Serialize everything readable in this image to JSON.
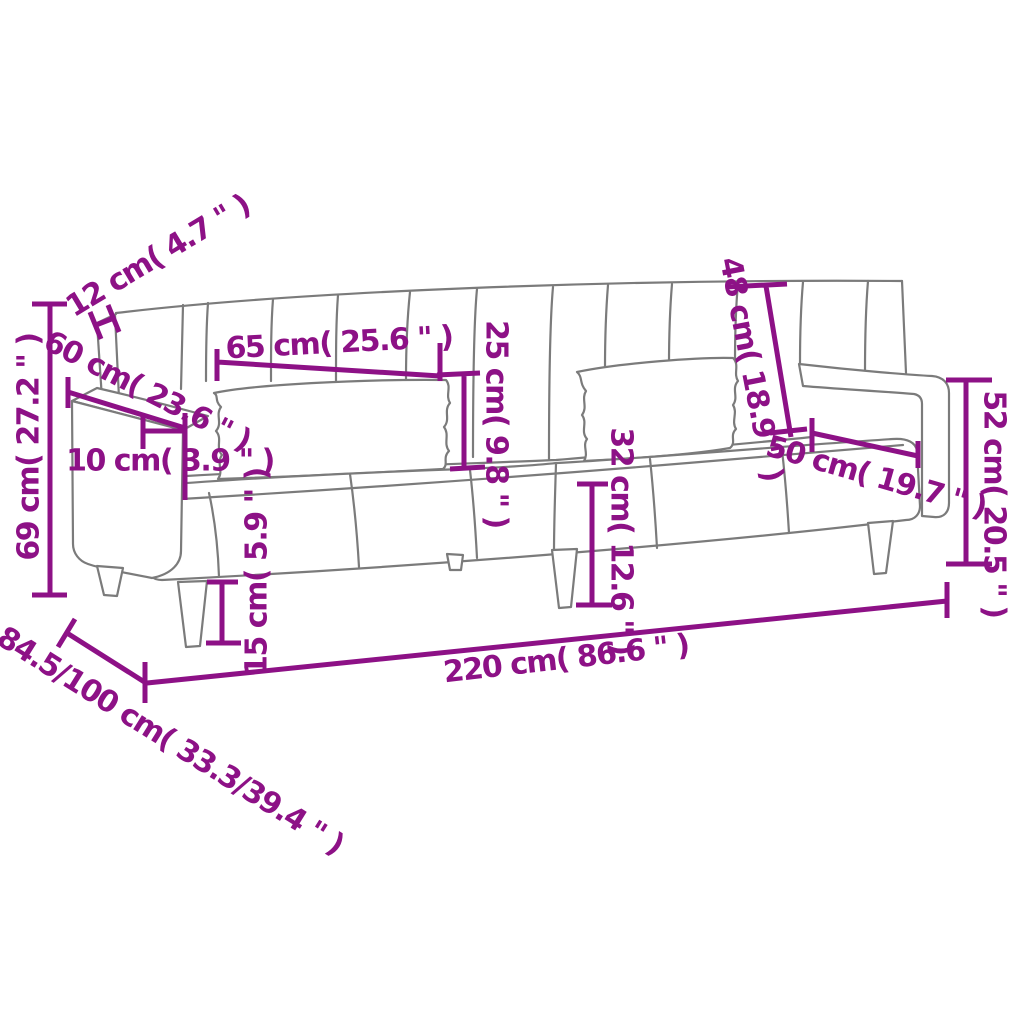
{
  "diagram_title": "Sofa bed dimension diagram",
  "colors": {
    "accent": "#8D1186",
    "outline": "#7B7B7B",
    "background": "#FFFFFF"
  },
  "dimensions": [
    {
      "name": "backrest-thickness",
      "label": "12 cm( 4.7 \" )"
    },
    {
      "name": "armrest-depth",
      "label": "60 cm( 23.6 \" )"
    },
    {
      "name": "armrest-width",
      "label": "10 cm( 3.9 \" )"
    },
    {
      "name": "armrest-height-left",
      "label": "69 cm( 27.2 \" )"
    },
    {
      "name": "cushion-length",
      "label": "65 cm( 25.6 \" )"
    },
    {
      "name": "cushion-height",
      "label": "25 cm( 9.8 \" )"
    },
    {
      "name": "backrest-height",
      "label": "48 cm( 18.9 \" )"
    },
    {
      "name": "seat-depth",
      "label": "50 cm( 19.7 \" )"
    },
    {
      "name": "armrest-height-right",
      "label": "52 cm( 20.5 \" )"
    },
    {
      "name": "seat-height",
      "label": "32 cm( 12.6 \" )"
    },
    {
      "name": "leg-height",
      "label": "15 cm( 5.9 \" )"
    },
    {
      "name": "total-length",
      "label": "220 cm( 86.6 \" )"
    },
    {
      "name": "total-depth",
      "label": "84.5/100 cm( 33.3/39.4 \" )"
    }
  ]
}
